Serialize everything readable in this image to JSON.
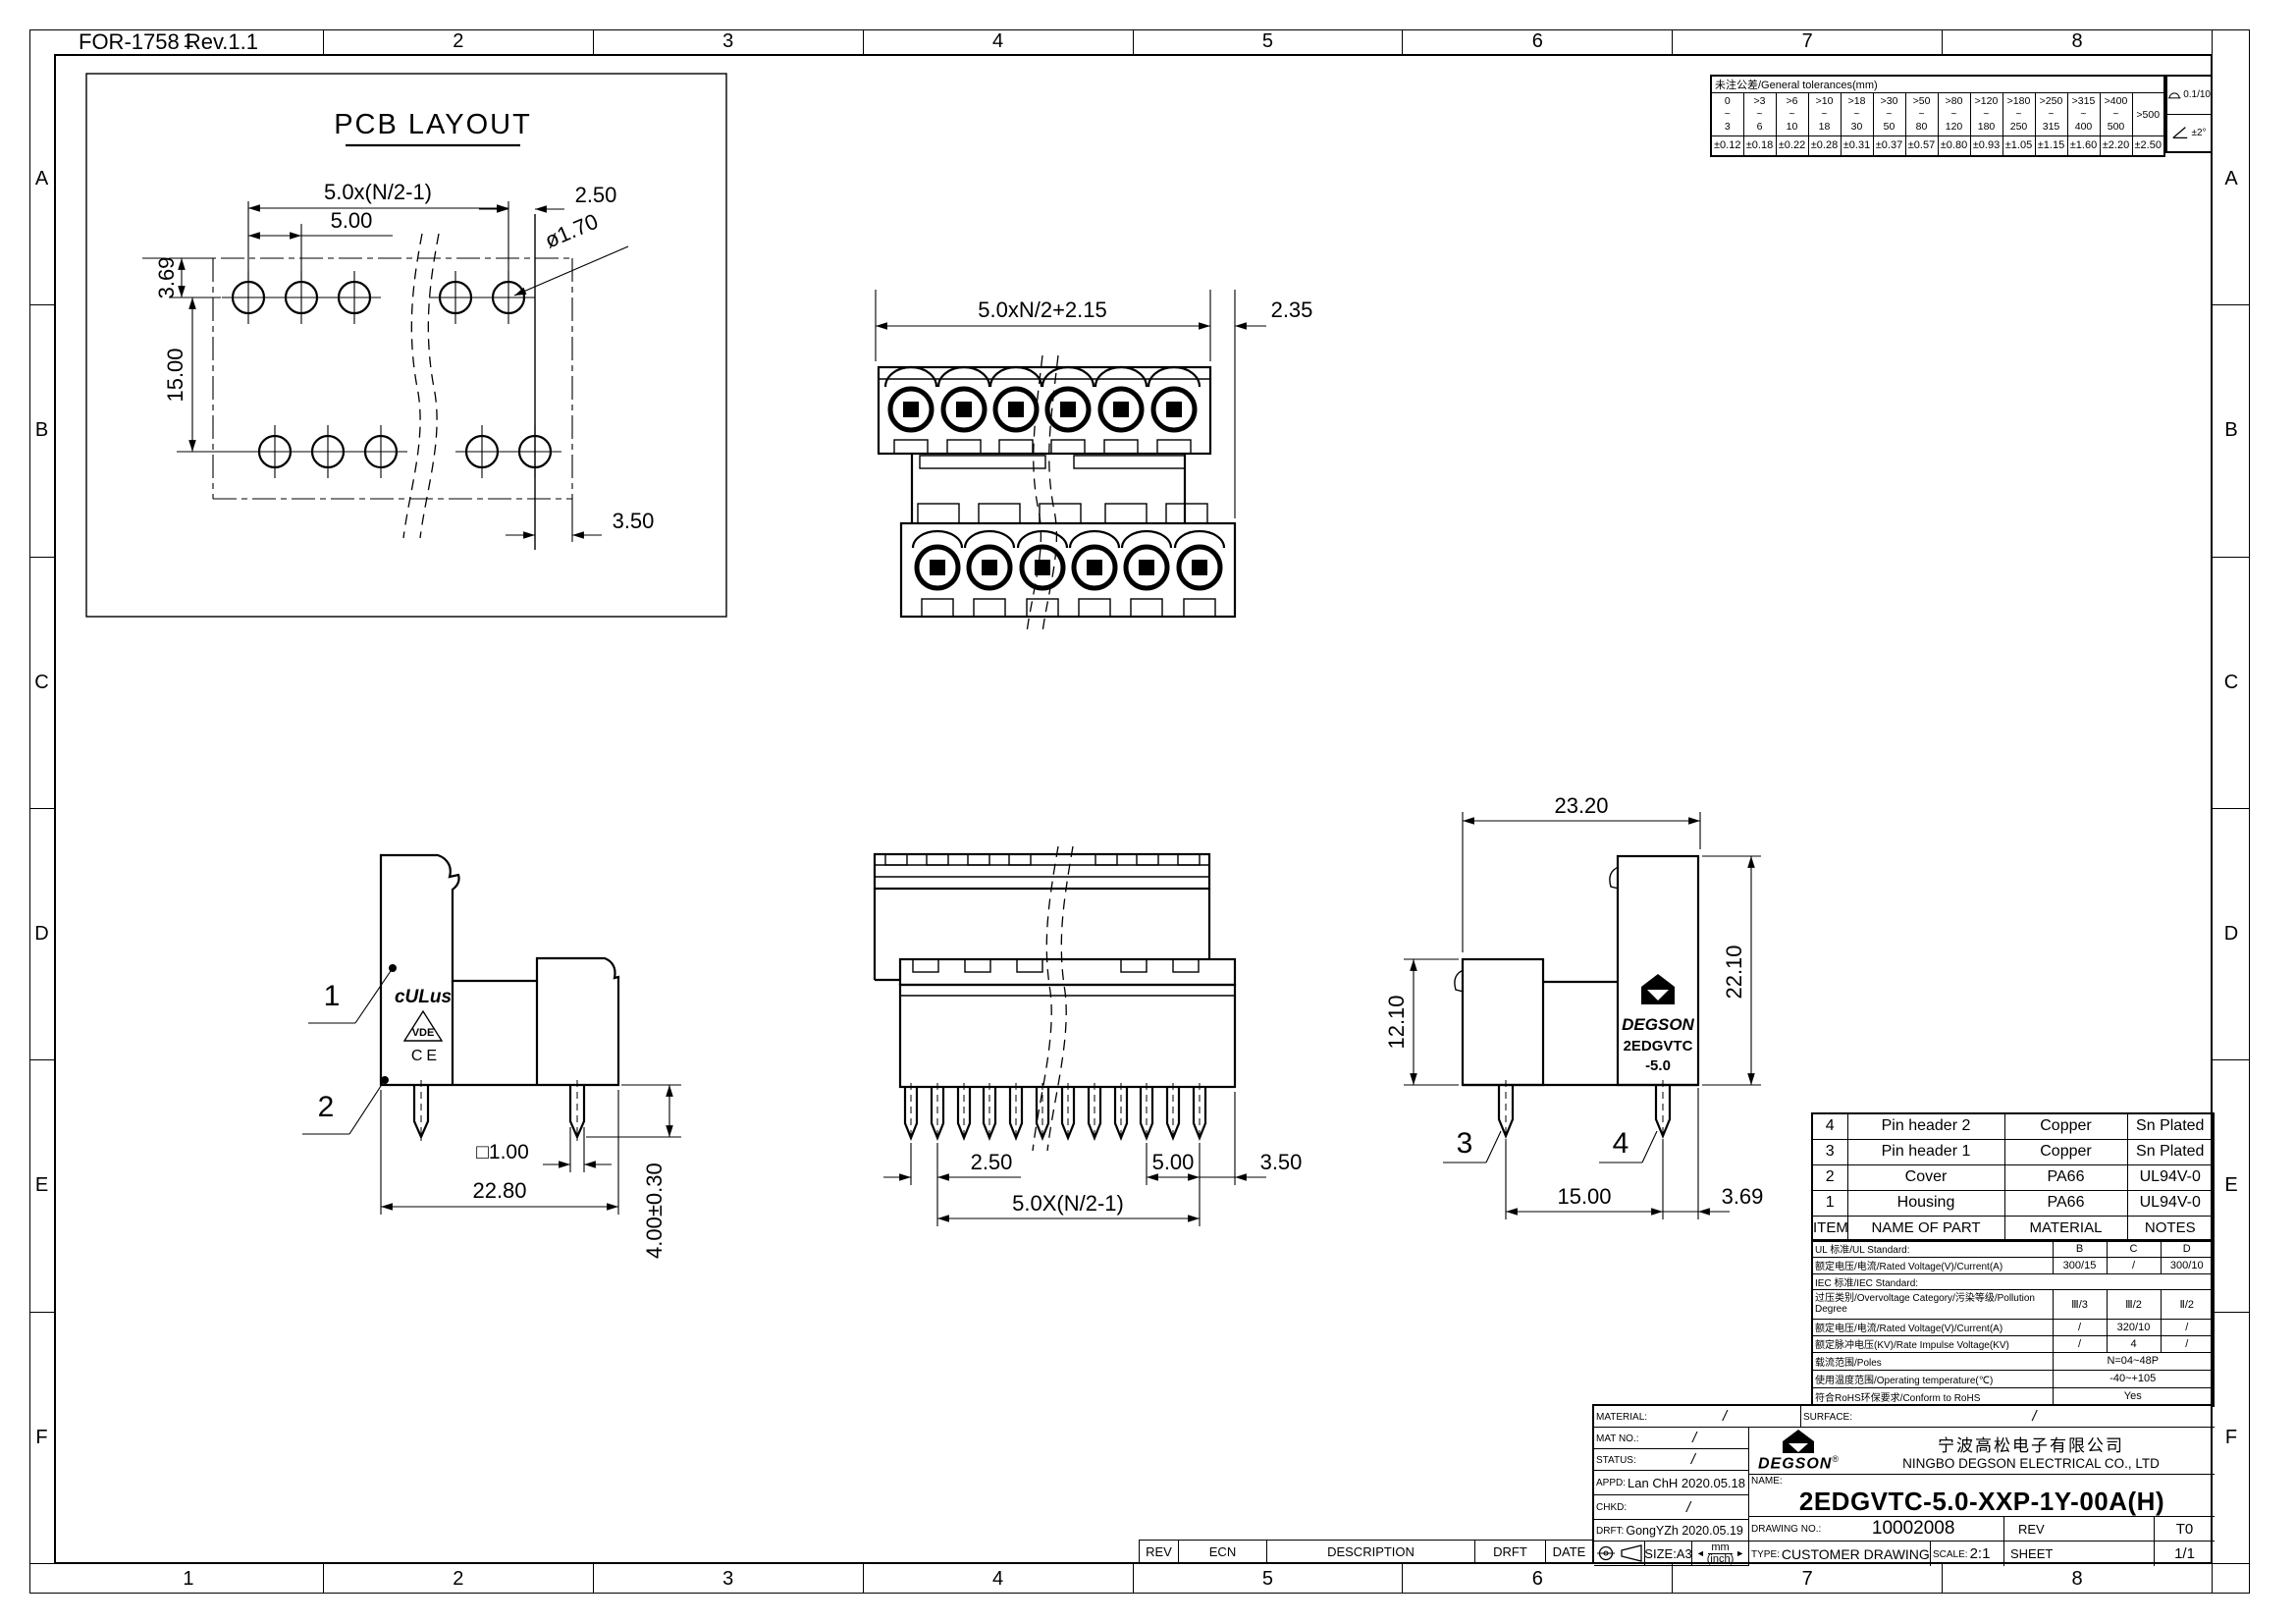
{
  "sheet_note": "FOR-1758 Rev.1.1",
  "border": {
    "cols": [
      "1",
      "2",
      "3",
      "4",
      "5",
      "6",
      "7",
      "8"
    ],
    "rows": [
      "A",
      "B",
      "C",
      "D",
      "E",
      "F"
    ]
  },
  "icons": {
    "arrow_left": "◄",
    "arrow_right": "►",
    "registered": "®"
  },
  "tolerance_table": {
    "title": "未注公差/General tolerances(mm)",
    "cols": [
      {
        "top": "0",
        "mid": "~",
        "bot": "3",
        "val": "±0.12"
      },
      {
        "top": ">3",
        "mid": "~",
        "bot": "6",
        "val": "±0.18"
      },
      {
        "top": ">6",
        "mid": "~",
        "bot": "10",
        "val": "±0.22"
      },
      {
        "top": ">10",
        "mid": "~",
        "bot": "18",
        "val": "±0.28"
      },
      {
        "top": ">18",
        "mid": "~",
        "bot": "30",
        "val": "±0.31"
      },
      {
        "top": ">30",
        "mid": "~",
        "bot": "50",
        "val": "±0.37"
      },
      {
        "top": ">50",
        "mid": "~",
        "bot": "80",
        "val": "±0.57"
      },
      {
        "top": ">80",
        "mid": "~",
        "bot": "120",
        "val": "±0.80"
      },
      {
        "top": ">120",
        "mid": "~",
        "bot": "180",
        "val": "±0.93"
      },
      {
        "top": ">180",
        "mid": "~",
        "bot": "250",
        "val": "±1.05"
      },
      {
        "top": ">250",
        "mid": "~",
        "bot": "315",
        "val": "±1.15"
      },
      {
        "top": ">315",
        "mid": "~",
        "bot": "400",
        "val": "±1.60"
      },
      {
        "top": ">400",
        "mid": "~",
        "bot": "500",
        "val": "±2.20"
      }
    ],
    "last_col": {
      "label": ">500",
      "val": "±2.50"
    },
    "flatness": "0.1/10",
    "angle": "±2°"
  },
  "views": {
    "pcb": {
      "title": "PCB LAYOUT",
      "pitch_total": "5.0x(N/2-1)",
      "pitch": "5.00",
      "edge_right": "2.50",
      "hole_dia": "ø1.70",
      "row_offset": "3.69",
      "row_spacing": "15.00",
      "edge_bottom": "3.50"
    },
    "front": {
      "width_total": "5.0xN/2+2.15",
      "offset_right": "2.35"
    },
    "side_left": {
      "callout_cover": "1",
      "callout_housing": "2",
      "pin_square": "□1.00",
      "body_width": "22.80",
      "pin_length": "4.00±0.30",
      "cert_ul": "cULus",
      "cert_vde": "VDE",
      "cert_ce": "CE"
    },
    "rear": {
      "pin_offset": "2.50",
      "pin_pitch": "5.00",
      "edge": "3.50",
      "pitch_total": "5.0X(N/2-1)"
    },
    "side_right": {
      "width": "23.20",
      "height": "22.10",
      "cover_height": "12.10",
      "pin_pitch": "15.00",
      "edge": "3.69",
      "callout_pin1": "3",
      "callout_pin2": "4",
      "marking_brand": "DEGSON",
      "marking_series": "2EDGVTC",
      "marking_size": "-5.0"
    }
  },
  "parts_table": {
    "headers": [
      "ITEM",
      "NAME OF PART",
      "MATERIAL",
      "NOTES"
    ],
    "rows": [
      {
        "item": "4",
        "name": "Pin header 2",
        "material": "Copper",
        "notes": "Sn Plated"
      },
      {
        "item": "3",
        "name": "Pin header 1",
        "material": "Copper",
        "notes": "Sn Plated"
      },
      {
        "item": "2",
        "name": "Cover",
        "material": "PA66",
        "notes": "UL94V-0"
      },
      {
        "item": "1",
        "name": "Housing",
        "material": "PA66",
        "notes": "UL94V-0"
      }
    ]
  },
  "spec_table": {
    "rows": [
      {
        "label": "UL 标准/UL Standard:",
        "c1": "B",
        "c2": "C",
        "c3": "D"
      },
      {
        "label": "额定电压/电流/Rated Voltage(V)/Current(A)",
        "c1": "300/15",
        "c2": "/",
        "c3": "300/10"
      },
      {
        "label": "IEC 标准/IEC Standard:"
      },
      {
        "label": "过压类别/Overvoltage Category/污染等级/Pollution Degree",
        "c1": "Ⅲ/3",
        "c2": "Ⅲ/2",
        "c3": "Ⅱ/2"
      },
      {
        "label": "额定电压/电流/Rated Voltage(V)/Current(A)",
        "c1": "/",
        "c2": "320/10",
        "c3": "/"
      },
      {
        "label": "额定脉冲电压(KV)/Rate Impulse Voltage(KV)",
        "c1": "/",
        "c2": "4",
        "c3": "/"
      },
      {
        "label": "载流范围/Poles",
        "merged": "N=04~48P"
      },
      {
        "label": "使用温度范围/Operating temperature(℃)",
        "merged": "-40~+105"
      },
      {
        "label": "符合RoHS环保要求/Conform to RoHS",
        "merged": "Yes"
      }
    ]
  },
  "title_block": {
    "material_label": "MATERIAL:",
    "material_value": "/",
    "surface_label": "SURFACE:",
    "surface_value": "/",
    "mat_no_label": "MAT NO.:",
    "mat_no_value": "/",
    "status_label": "STATUS:",
    "status_value": "/",
    "appd_label": "APPD:",
    "appd_value": "Lan ChH 2020.05.18",
    "chkd_label": "CHKD:",
    "chkd_value": "/",
    "drft_label": "DRFT:",
    "drft_value": "GongYZh 2020.05.19",
    "brand": "DEGSON",
    "company_cn": "宁波高松电子有限公司",
    "company_en": "NINGBO DEGSON ELECTRICAL CO., LTD",
    "name_label": "NAME:",
    "part_number": "2EDGVTC-5.0-XXP-1Y-00A(H)",
    "drawing_no_label": "DRAWING NO.:",
    "drawing_no": "10002008",
    "rev_label": "REV",
    "rev_value": "T0",
    "type_label": "TYPE:",
    "type_value": "CUSTOMER DRAWING",
    "scale_label": "SCALE:",
    "scale_value": "2:1",
    "sheet_label": "SHEET",
    "sheet_value": "1/1",
    "size_label": "SIZE:A3",
    "units_top": "mm",
    "units_bottom": "(inch)"
  },
  "revision_strip": {
    "headers": [
      "REV",
      "ECN",
      "DESCRIPTION",
      "DRFT",
      "DATE"
    ]
  }
}
